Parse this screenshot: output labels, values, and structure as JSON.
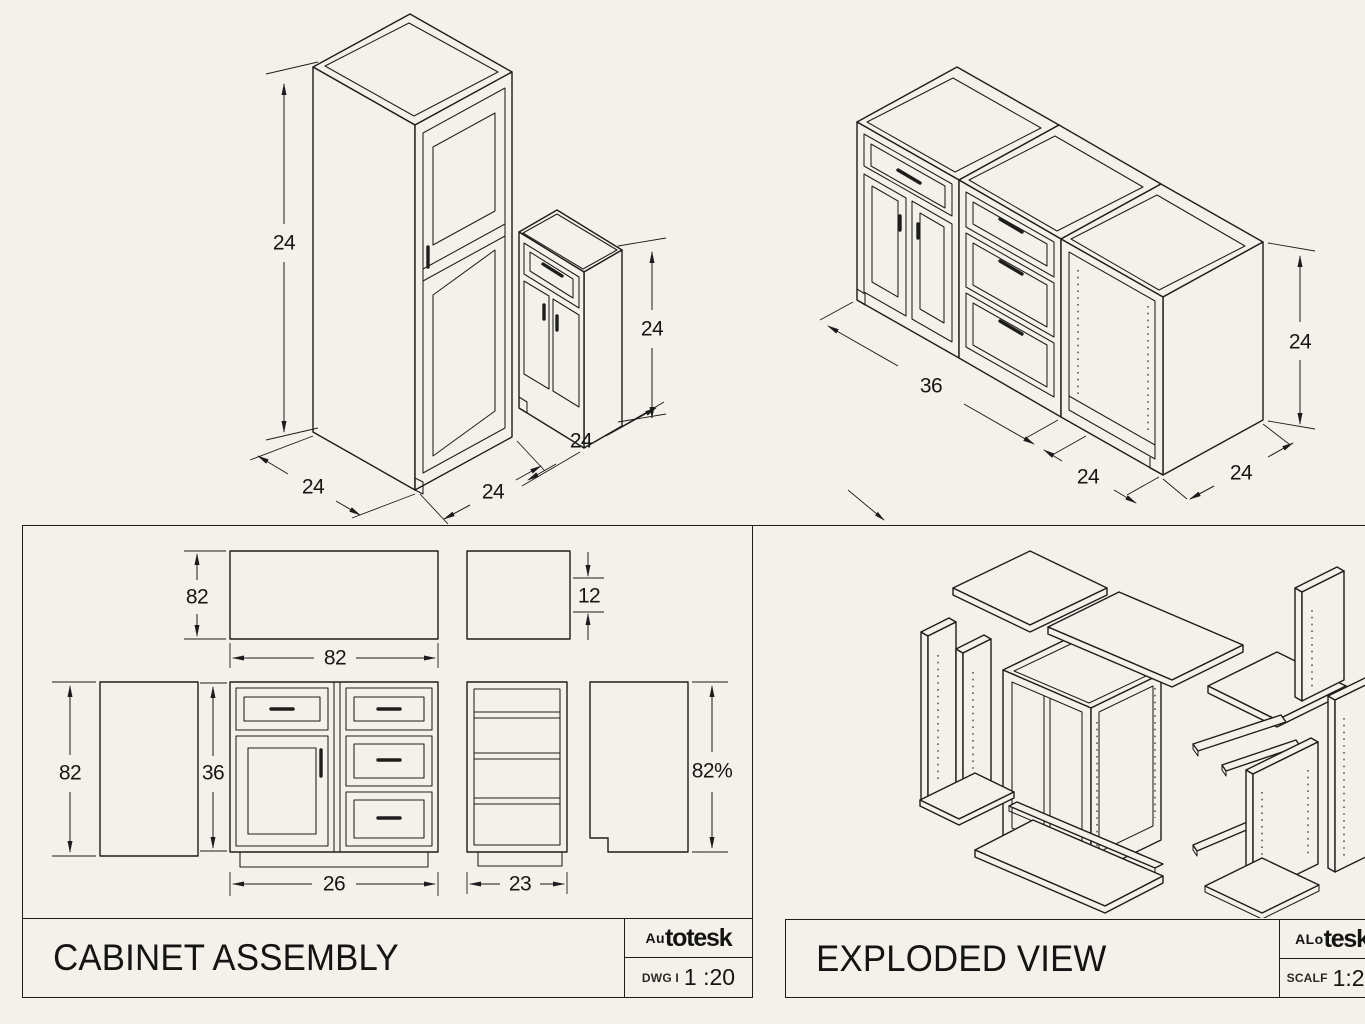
{
  "sheet": {
    "background": "#f4f1ea",
    "line_color": "#1d1d1b"
  },
  "iso_left": {
    "description": "tall cabinet with small base cabinet, isometric view",
    "dims": {
      "tall_height": "24",
      "tall_depth": "24",
      "tall_width": "24",
      "base_depth": "24",
      "base_height": "24"
    }
  },
  "iso_right": {
    "description": "three base cabinet run, isometric view",
    "dims": {
      "run_length": "36",
      "cabinet_width": "24",
      "cabinet_depth": "24",
      "cabinet_height": "24"
    }
  },
  "assembly_panel": {
    "title": "CABINET ASSEMBLY",
    "brand": {
      "prefix": "Au",
      "suffix": "totesk"
    },
    "scale_label": "DWG I",
    "scale_value": "1 :20",
    "dims": {
      "panel_height": "82",
      "panel_width": "82",
      "top_thickness": "12",
      "side_height": "82",
      "cabinet_height": "36",
      "cabinet_width": "26",
      "carcass_width": "23",
      "side_panel_height": "82%"
    }
  },
  "exploded_panel": {
    "title": "EXPLODED VIEW",
    "brand": {
      "prefix": "ALo",
      "suffix": "tesk"
    },
    "scale_label": "SCALF",
    "scale_value": "1:20"
  }
}
